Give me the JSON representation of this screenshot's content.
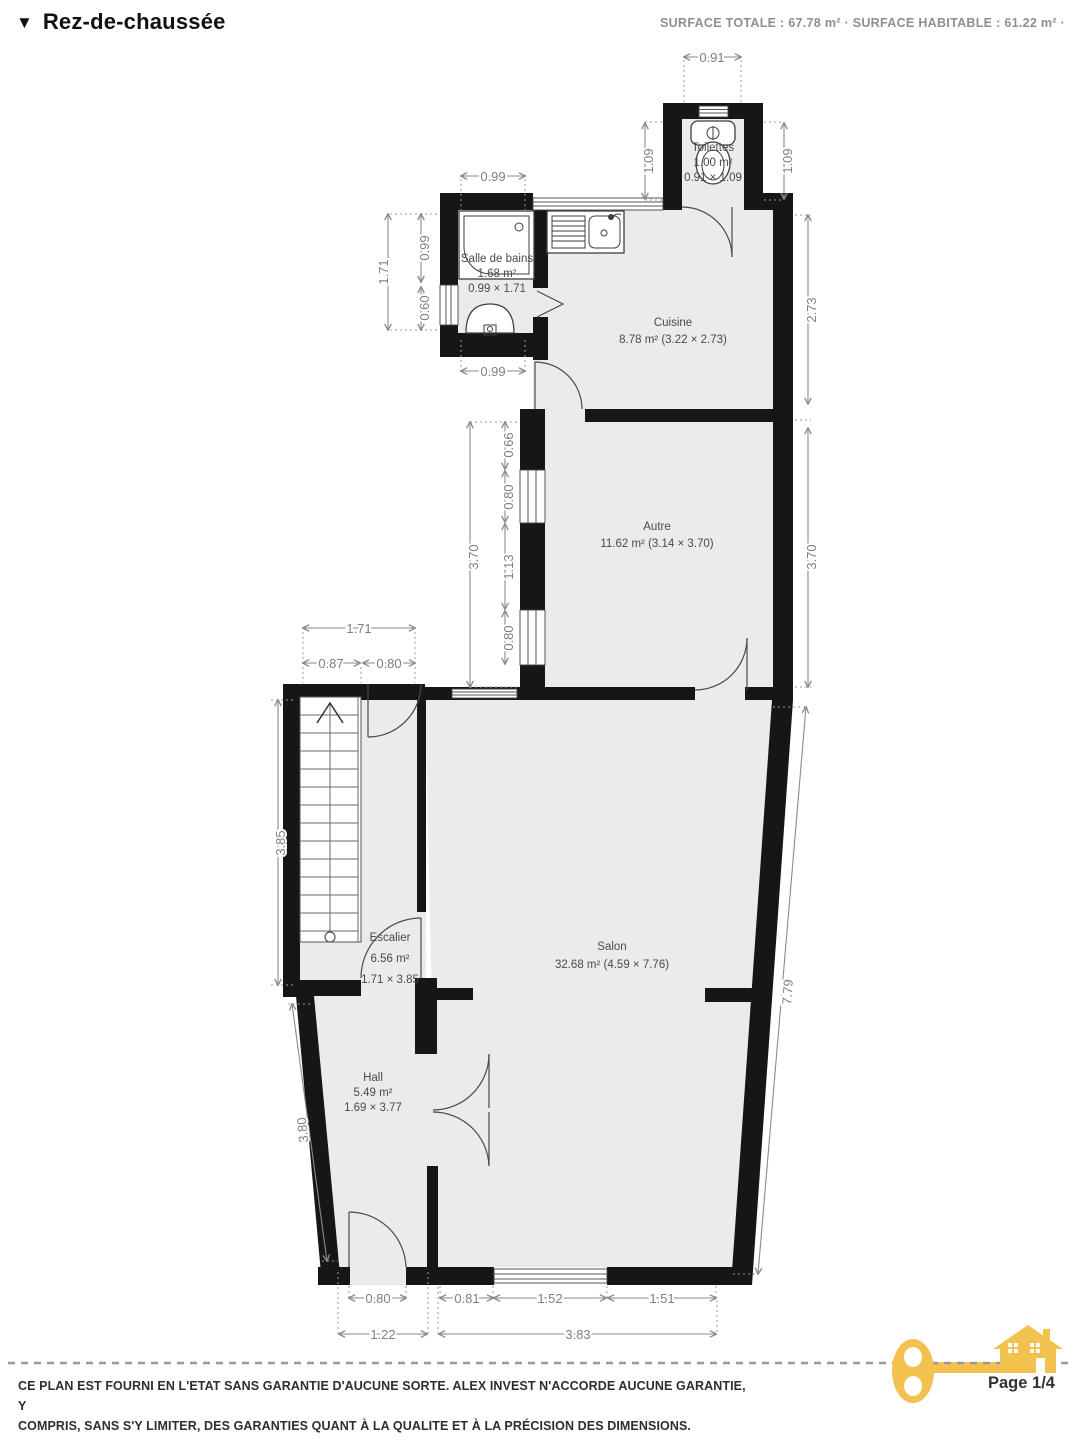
{
  "header": {
    "collapse_icon": "▼",
    "title": "Rez-de-chaussée",
    "surface_summary": "SURFACE TOTALE : 67.78 m² · SURFACE HABITABLE : 61.22 m² ·"
  },
  "rooms": {
    "toilettes": {
      "name": "Toilettes",
      "line2": "1.00 m²",
      "line3": "0.91 × 1.09"
    },
    "salle_de_bains": {
      "name": "Salle de bains",
      "line2": "1.68 m²",
      "line3": "0.99 × 1.71"
    },
    "cuisine": {
      "name": "Cuisine",
      "line2": "8.78 m² (3.22 × 2.73)"
    },
    "autre": {
      "name": "Autre",
      "line2": "11.62 m² (3.14 × 3.70)"
    },
    "escalier": {
      "name": "Escalier",
      "line2": "6.56 m²",
      "line3": "1.71 × 3.85"
    },
    "salon": {
      "name": "Salon",
      "line2": "32.68 m² (4.59 × 7.76)"
    },
    "hall": {
      "name": "Hall",
      "line2": "5.49 m²",
      "line3": "1.69 × 3.77"
    }
  },
  "dimensions": {
    "toilettes_width": "0.91",
    "toilettes_left": "1.09",
    "toilettes_right": "1.09",
    "sdb_width_top": "0.99",
    "sdb_height": "1.71",
    "sdb_left_a": "0.99",
    "sdb_left_b": "0.60",
    "sdb_width_bottom": "0.99",
    "cuisine_height": "2.73",
    "autre_height_left_total": "3.70",
    "autre_seg_a": "0.66",
    "autre_seg_b": "0.80",
    "autre_seg_c": "1.13",
    "autre_seg_d": "0.80",
    "autre_height_right": "3.70",
    "esc_width_total": "1.71",
    "esc_stairs_width": "0.87",
    "esc_door": "0.80",
    "esc_height": "3.85",
    "salon_right_side": "7.79",
    "hall_left_side": "3.80",
    "hall_door": "0.80",
    "salon_seg_a": "0.81",
    "salon_window": "1.52",
    "salon_seg_b": "1.51",
    "hall_width_total": "1.22",
    "salon_width_total": "3.83"
  },
  "footer": {
    "disclaimer_line1": "CE PLAN EST FOURNI EN L'ETAT SANS GARANTIE D'AUCUNE SORTE. ALEX INVEST N'ACCORDE AUCUNE GARANTIE, Y",
    "disclaimer_line2": "COMPRIS, SANS S'Y LIMITER, DES GARANTIES QUANT À LA QUALITE ET À LA PRÉCISION DES DIMENSIONS.",
    "page_indicator": "Page 1/4"
  },
  "colors": {
    "wall": "#161616",
    "floor": "#EBEBEB",
    "dimension": "#7F7F7F",
    "accent_yellow": "#F2C14E"
  }
}
